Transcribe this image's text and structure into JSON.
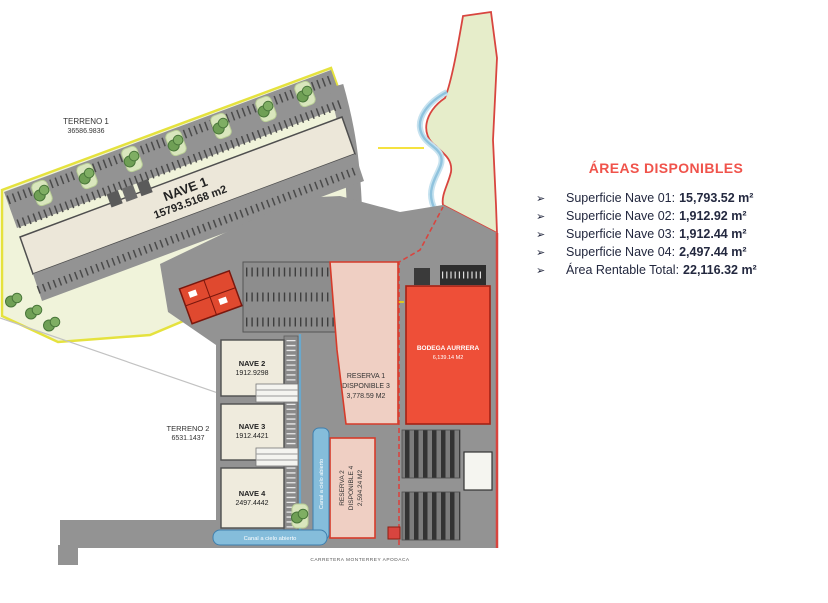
{
  "legend": {
    "title": "ÁREAS DISPONIBLES",
    "bullet": "➢",
    "title_color": "#f0534b",
    "text_color": "#23283f",
    "items": [
      {
        "label": "Superficie Nave 01:",
        "value": "15,793.52 m²"
      },
      {
        "label": "Superficie Nave 02:",
        "value": "1,912.92 m²"
      },
      {
        "label": "Superficie Nave 03:",
        "value": "1,912.44 m²"
      },
      {
        "label": "Superficie Nave 04:",
        "value": "2,497.44 m²"
      },
      {
        "label": "Área Rentable Total:",
        "value": "22,116.32 m²"
      }
    ]
  },
  "site_plan": {
    "terreno1": {
      "name": "TERRENO 1",
      "area": "36586.9836"
    },
    "terreno2": {
      "name": "TERRENO 2",
      "area": "6531.1437"
    },
    "nave1": {
      "name": "NAVE 1",
      "area": "15793.5168 m2"
    },
    "nave2": {
      "name": "NAVE 2",
      "area": "1912.9298"
    },
    "nave3": {
      "name": "NAVE 3",
      "area": "1912.4421"
    },
    "nave4": {
      "name": "NAVE 4",
      "area": "2497.4442"
    },
    "reserva1": {
      "line1": "RESERVA 1",
      "line2": "DISPONIBLE 3",
      "line3": "3,778.59 M2"
    },
    "reserva2": {
      "line1": "RESERVA 2",
      "line2": "DISPONIBLE 4",
      "line3": "2,594.24 M2"
    },
    "bodega": {
      "name": "BODEGA AURRERA",
      "area": "6,139.14 M2"
    },
    "canal_label": "Canal a cielo abierto",
    "road_label": "CARRETERA MONTERREY APODACA",
    "colors": {
      "parcel1_fill": "#f0f3da",
      "parcel1_border": "#e5e23e",
      "parcel2_fill": "#e6edca",
      "parcel2_border": "#d8453f",
      "pavement": "#939393",
      "building_fill": "#ece7d9",
      "bodega_fill": "#ee4f38",
      "reserva_fill": "#efcfc3",
      "canal_fill": "#85bddb",
      "stream": "#8fc3de"
    }
  }
}
